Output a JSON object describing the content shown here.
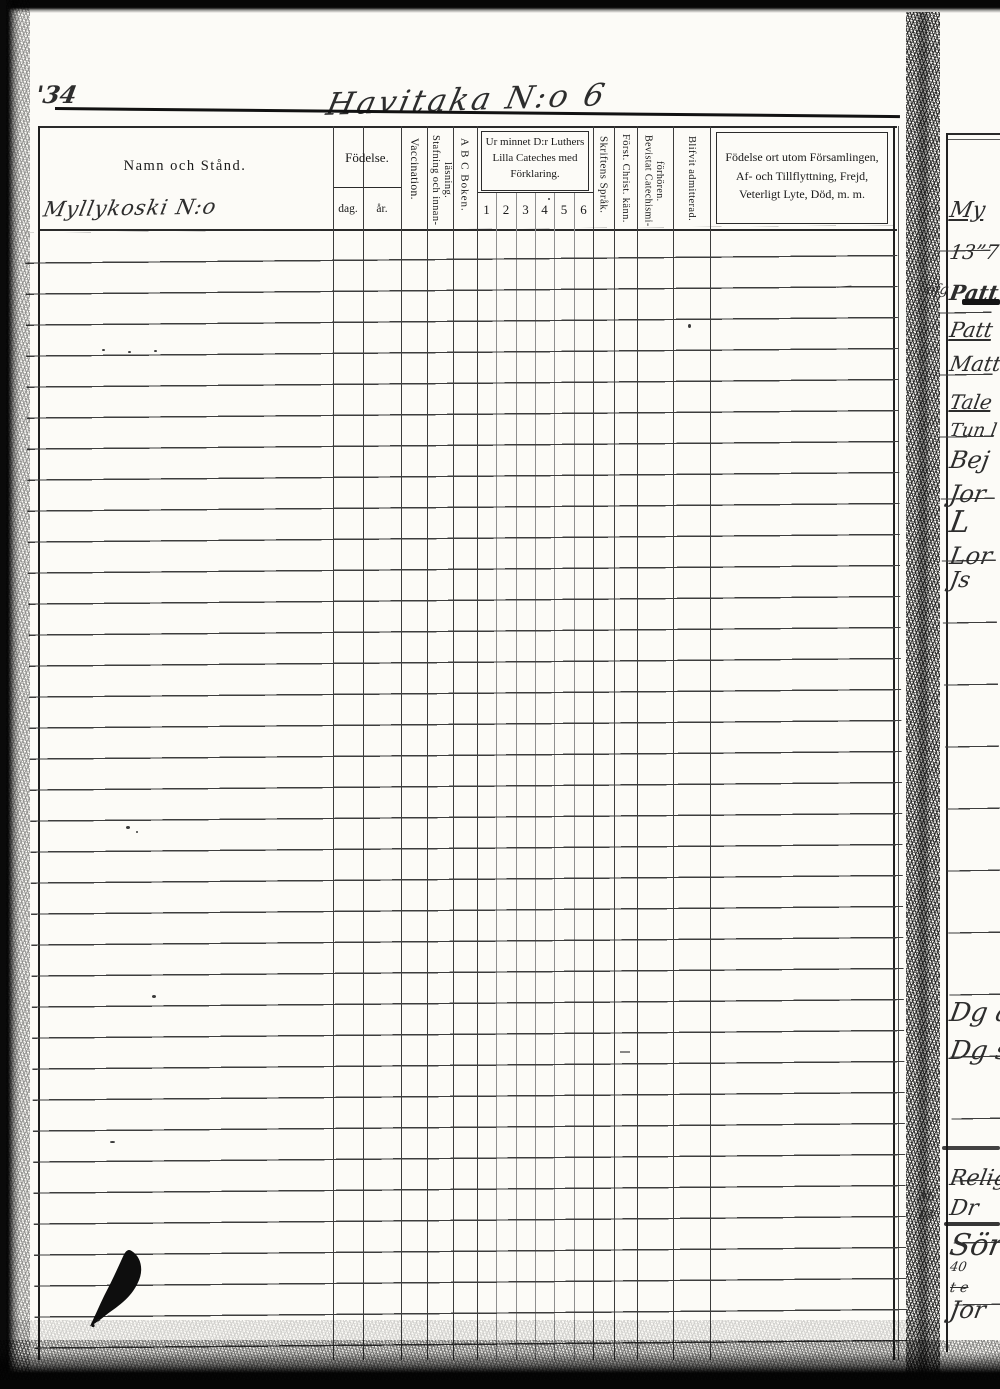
{
  "page": {
    "number": "'34",
    "title": "Havitaka N:o 6"
  },
  "header": {
    "name": "Namn och Stånd.",
    "birth": {
      "label": "Födelse.",
      "day": "dag.",
      "year": "år."
    },
    "vaccination": "Vaccination.",
    "spelling_reading": "Stafning och innan-läsning.",
    "abc_book": "A B C Boken.",
    "catechism": {
      "label": "Ur minnet D:r Luthers Lilla Cateches med Förklaring.",
      "grades": [
        "1",
        "2",
        "3",
        "4",
        "5",
        "6"
      ]
    },
    "scripture_language": "Skriftens Språk.",
    "christian_knowledge": "Först. Christ. känn.",
    "catechism_meetings": "Bevistat Catechismi-förhören.",
    "admitted": "Blifvit admitterad.",
    "notes": "Födelse ort utom Församlingen, Af- och Tillflyttning, Frejd, Veterligt Lyte, Död, m. m."
  },
  "entries": {
    "village": "Myllykoski N:o",
    "pen_dash": "—"
  },
  "right_page": {
    "fragments": [
      "My",
      "13”7",
      "Patt",
      "Patt",
      "Matt",
      "Tale",
      "Tun l",
      "Bej",
      "Jor",
      "L",
      "Lor",
      "Js",
      "Dg a",
      "Dg s",
      "Relig",
      "Dr",
      "Sör",
      "40",
      "t e",
      "Jor"
    ],
    "gutter_marks": [
      "ofg",
      "Ab",
      "18"
    ]
  }
}
